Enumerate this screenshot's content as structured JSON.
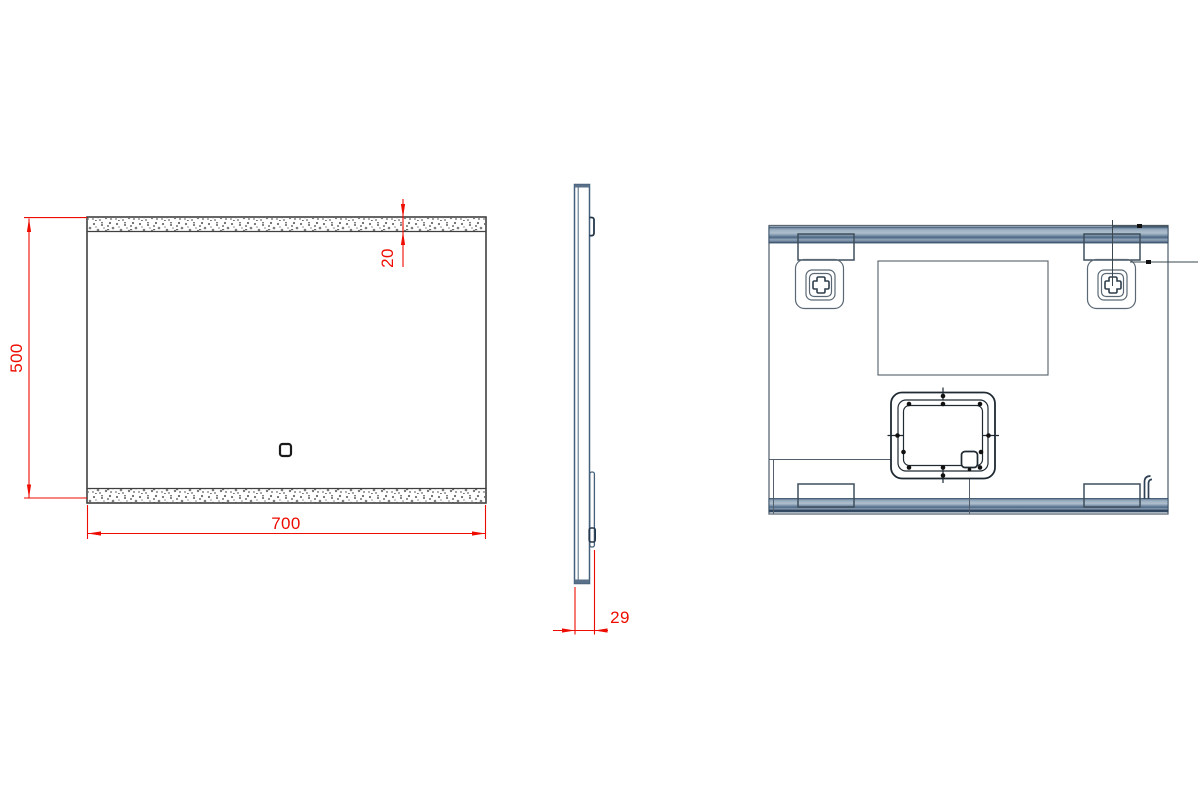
{
  "dimensions": {
    "width_mm": "700",
    "height_mm": "500",
    "led_strip_mm": "20",
    "depth_mm": "29"
  },
  "colors": {
    "dimension_red": "#ee0b00",
    "outline_dark": "#404040",
    "steel_stroke": "#53606b",
    "rail_light": "#a9bac9",
    "rail_dark": "#47617e"
  }
}
